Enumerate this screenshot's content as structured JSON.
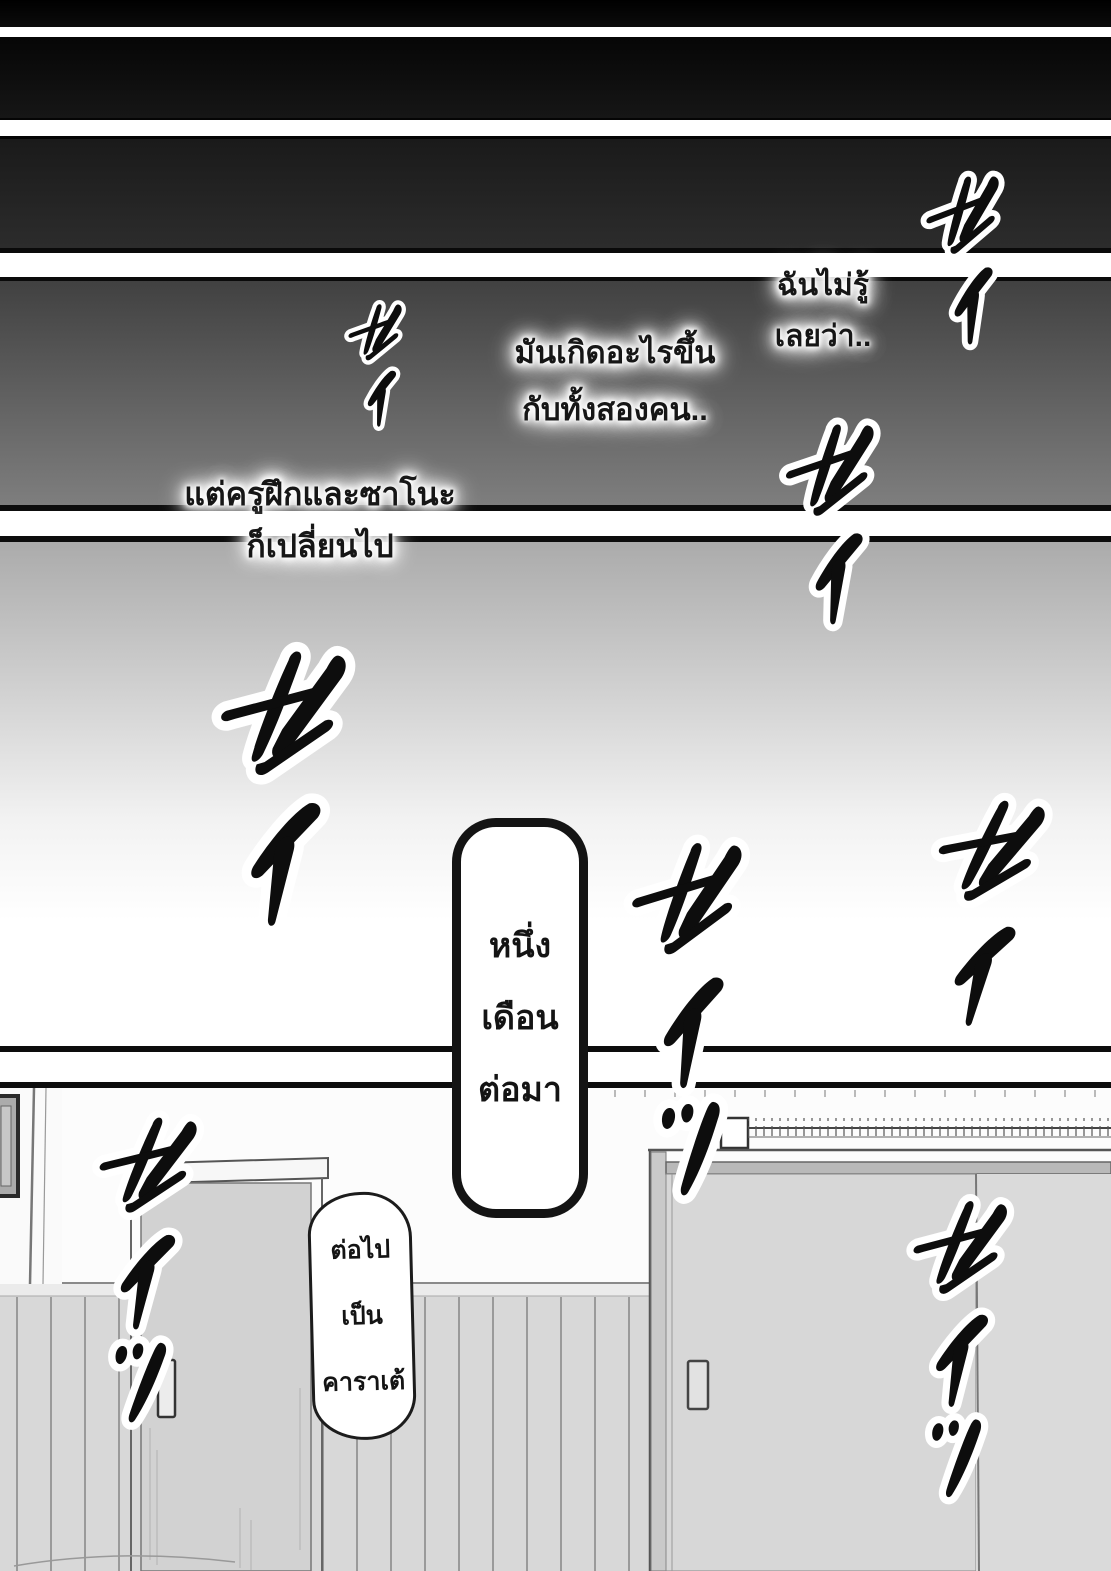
{
  "page": {
    "title": "manga-page",
    "narration": {
      "n1_line1": "ฉันไม่รู้",
      "n1_line2": "เลยว่า..",
      "n2_line1": "มันเกิดอะไรขึ้น",
      "n2_line2": "กับทั้งสองคน..",
      "n3_line1": "แต่ครูฝึกและซาโนะ",
      "n3_line2": "ก็เปลี่ยนไป"
    },
    "time_box": {
      "line1": "หนึ่ง",
      "line2": "เดือน",
      "line3": "ต่อมา"
    },
    "speech_bubble": {
      "line1": "ต่อไป",
      "line2": "เป็น",
      "line3": "คาราเต้"
    },
    "sfx": [
      {
        "id": "top-right",
        "text": "セイ",
        "reading": "sei"
      },
      {
        "id": "upper-left",
        "text": "セイ",
        "reading": "sei"
      },
      {
        "id": "mid-right",
        "text": "セイ",
        "reading": "sei"
      },
      {
        "id": "left-large",
        "text": "セイ",
        "reading": "sei"
      },
      {
        "id": "center",
        "text": "セイッ",
        "reading": "sei!"
      },
      {
        "id": "right",
        "text": "セイ",
        "reading": "sei"
      },
      {
        "id": "bottom-left",
        "text": "セイッ",
        "reading": "sei!"
      },
      {
        "id": "bottom-right",
        "text": "セイッ",
        "reading": "sei!"
      }
    ],
    "colors": {
      "ink": "#111111",
      "gutter_white": "#ffffff",
      "panel_dark": "#0a0a0a",
      "wainscot_wall": "#d8d8d8",
      "door_gray": "#d6d6d6",
      "halo": "#ffffff"
    }
  }
}
